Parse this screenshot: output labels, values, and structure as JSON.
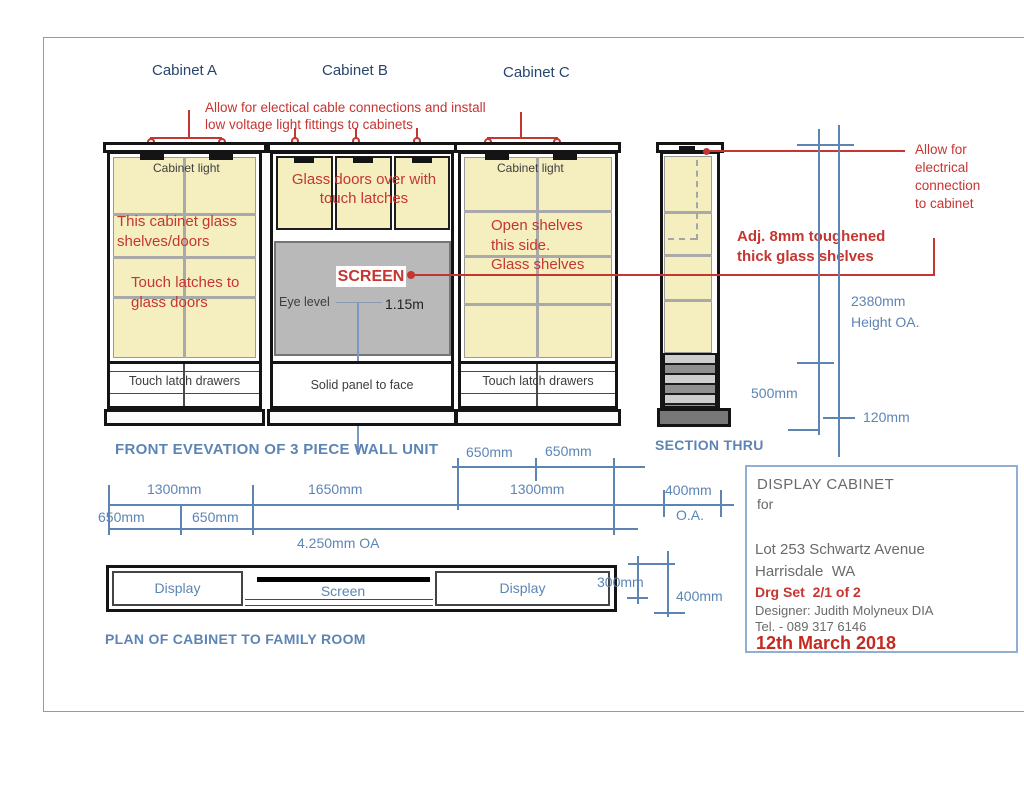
{
  "colors": {
    "red": "#c53531",
    "dim_blue": "#5d85b4",
    "navy": "#26466f",
    "panel_yellow": "#f5efc0",
    "screen_gray": "#b9b9b9",
    "title_gray": "#6a6a6a"
  },
  "header": {
    "cabinet_a": "Cabinet A",
    "cabinet_b": "Cabinet B",
    "cabinet_c": "Cabinet C"
  },
  "annotations": {
    "top_cable_note": "Allow for electical cable connections and install\nlow voltage light fittings to cabinets",
    "allow_connection": "Allow for\nelectrical\nconnection\nto cabinet",
    "adj_glass": "Adj. 8mm toughened\nthick glass shelves"
  },
  "elevation": {
    "caption": "FRONT EVEVATION OF 3 PIECE WALL UNIT",
    "cabinet_a": {
      "light_label": "Cabinet light",
      "note_glass": "This cabinet glass\nshelves/doors",
      "note_latches": "Touch latches to\nglass doors",
      "drawers_label": "Touch latch drawers"
    },
    "cabinet_b": {
      "doors_note": "Glass doors over with\ntouch latches",
      "screen_label": "SCREEN",
      "eye_level_label": "Eye level",
      "eye_height": "1.15m",
      "solid_panel_label": "Solid panel to face"
    },
    "cabinet_c": {
      "light_label": "Cabinet light",
      "note_shelves": "Open shelves\nthis side.\nGlass shelves",
      "drawers_label": "Touch latch drawers"
    }
  },
  "section": {
    "caption": "SECTION THRU",
    "height_value": "2380mm",
    "height_label": "Height OA.",
    "dim_500": "500mm",
    "dim_120": "120mm"
  },
  "front_dims": {
    "d1300_left": "1300mm",
    "d1650": "1650mm",
    "d1300_right": "1300mm",
    "d650_top_left": "650mm",
    "d650_top_right": "650mm",
    "d650_bot_left": "650mm",
    "d650_bot_right": "650mm",
    "total": "4.250mm OA",
    "d400": "400mm",
    "oa": "O.A."
  },
  "plan": {
    "caption": "PLAN OF CABINET TO FAMILY ROOM",
    "display_left": "Display",
    "screen": "Screen",
    "display_right": "Display",
    "d300": "300mm",
    "d400": "400mm"
  },
  "title_block": {
    "title": "DISPLAY CABINET",
    "for_label": "for",
    "address1": "Lot 253 Schwartz Avenue",
    "address2": "Harrisdale  WA",
    "drg_set": "Drg Set  2/1 of 2",
    "designer": "Designer: Judith Molyneux DIA",
    "tel": "Tel. - 089 317 6146",
    "date": "12th March 2018"
  }
}
